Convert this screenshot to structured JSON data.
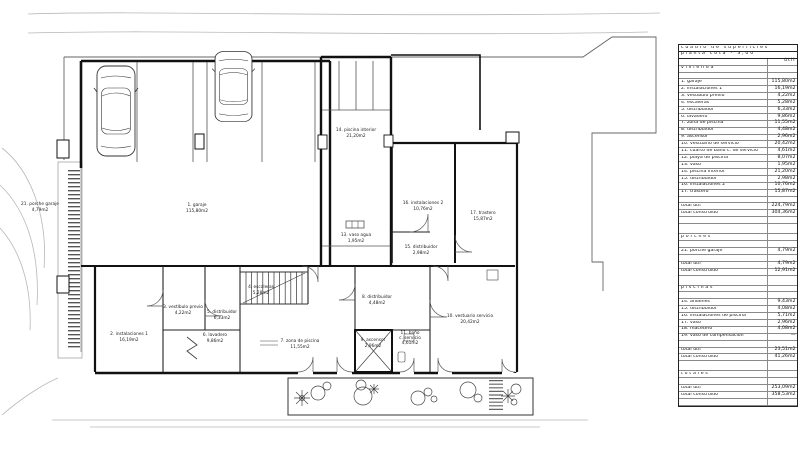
{
  "colors": {
    "line": "#111111",
    "background": "#ffffff"
  },
  "table": {
    "title1": "cuadro de superficies",
    "title2": "planta cota - 3,00",
    "col_util": "útil",
    "rows": [
      {
        "type": "title",
        "label": "cuadro de superficies"
      },
      {
        "type": "title",
        "label": "planta cota - 3,00"
      },
      {
        "type": "colhead",
        "label": "",
        "value": "útil"
      },
      {
        "type": "section",
        "label": "vivienda",
        "value": ""
      },
      {
        "type": "blank",
        "label": "",
        "value": ""
      },
      {
        "type": "item",
        "label": "1. garaje",
        "value": "115,80m2"
      },
      {
        "type": "item",
        "label": "2. instalaciones 1",
        "value": "16,19m2"
      },
      {
        "type": "item",
        "label": "3. vestíbulo previo",
        "value": "4,22m2"
      },
      {
        "type": "item",
        "label": "4. escaleras",
        "value": "5,28m2"
      },
      {
        "type": "item",
        "label": "5. distribuidor",
        "value": "6,33m2"
      },
      {
        "type": "item",
        "label": "6. lavadero",
        "value": "9,86m2"
      },
      {
        "type": "item",
        "label": "7. zona de piscina",
        "value": "11,55m2"
      },
      {
        "type": "item",
        "label": "8. distribuidor",
        "value": "4,48m2"
      },
      {
        "type": "item",
        "label": "9. ascensor",
        "value": "2,96m2"
      },
      {
        "type": "item",
        "label": "10. vestuario de servicio",
        "value": "20,42m2"
      },
      {
        "type": "item",
        "label": "11. cuarto de baño c. de servicio",
        "value": "4,61m2"
      },
      {
        "type": "item",
        "label": "12. playa de piscina",
        "value": "8,07m2"
      },
      {
        "type": "item",
        "label": "13. vaso",
        "value": "1,95m2"
      },
      {
        "type": "item",
        "label": "14. piscina interior",
        "value": "21,20m2"
      },
      {
        "type": "item",
        "label": "15. distribuidor",
        "value": "2,98m2"
      },
      {
        "type": "item",
        "label": "16. instalaciones 2",
        "value": "10,76m2"
      },
      {
        "type": "item",
        "label": "17. trastero",
        "value": "15,87m2"
      },
      {
        "type": "blank",
        "label": "",
        "value": ""
      },
      {
        "type": "total",
        "label": "total útil",
        "value": "224,79m2"
      },
      {
        "type": "total",
        "label": "total construido",
        "value": "304,36m2"
      },
      {
        "type": "blank",
        "label": "",
        "value": ""
      },
      {
        "type": "blank2",
        "label": "",
        "value": ""
      },
      {
        "type": "section",
        "label": "porches",
        "value": ""
      },
      {
        "type": "blank",
        "label": "",
        "value": ""
      },
      {
        "type": "item",
        "label": "21. porche garaje",
        "value": "4,79m2"
      },
      {
        "type": "blank",
        "label": "",
        "value": ""
      },
      {
        "type": "total",
        "label": "total útil",
        "value": "4,79m2"
      },
      {
        "type": "total",
        "label": "total construido",
        "value": "12,91m2"
      },
      {
        "type": "blank2",
        "label": "",
        "value": ""
      },
      {
        "type": "section",
        "label": "piscinas",
        "value": ""
      },
      {
        "type": "blank",
        "label": "",
        "value": ""
      },
      {
        "type": "item",
        "label": "14. andenes",
        "value": "9,43m2"
      },
      {
        "type": "item",
        "label": "15. distribuidor",
        "value": "4,08m2"
      },
      {
        "type": "item",
        "label": "16. instalaciones de piscina",
        "value": "5,71m2"
      },
      {
        "type": "item",
        "label": "17. vaso",
        "value": "2,96m2"
      },
      {
        "type": "item",
        "label": "18. macetero",
        "value": "4,08m2"
      },
      {
        "type": "item",
        "label": "19. vaso de compensación",
        "value": "—"
      },
      {
        "type": "blank",
        "label": "",
        "value": ""
      },
      {
        "type": "total",
        "label": "total útil",
        "value": "23,51m2"
      },
      {
        "type": "total",
        "label": "total construido",
        "value": "41,26m2"
      },
      {
        "type": "blank2",
        "label": "",
        "value": ""
      },
      {
        "type": "section",
        "label": "totales",
        "value": ""
      },
      {
        "type": "blank",
        "label": "",
        "value": ""
      },
      {
        "type": "total",
        "label": "total útil",
        "value": "253,09m2"
      },
      {
        "type": "total",
        "label": "total construido",
        "value": "358,53m2"
      },
      {
        "type": "blank",
        "label": "",
        "value": ""
      }
    ]
  },
  "plan": {
    "rooms": [
      {
        "name": "1. garaje",
        "area": "115,80m2"
      },
      {
        "name": "2. instalaciones 1",
        "area": "16,19m2"
      },
      {
        "name": "3. vestíbulo previo",
        "area": "4,22m2"
      },
      {
        "name": "4. escaleras",
        "area": "5,28m2"
      },
      {
        "name": "5. distribuidor",
        "area": "6,33m2"
      },
      {
        "name": "6. lavadero",
        "area": "9,86m2"
      },
      {
        "name": "7. zona de piscina",
        "area": "11,55m2"
      },
      {
        "name": "8. distribuidor",
        "area": "4,48m2"
      },
      {
        "name": "9. ascensor",
        "area": "2,96m2"
      },
      {
        "name": "10. vestuario servicio",
        "area": "20,42m2"
      },
      {
        "name": "11. baño",
        "name2": "c. servicio",
        "area": "4,61m2"
      },
      {
        "name": "13. vaso agua",
        "area": "1,95m2"
      },
      {
        "name": "14. piscina interior",
        "area": "21,20m2"
      },
      {
        "name": "15. distribuidor",
        "area": "2,98m2"
      },
      {
        "name": "16. instalaciones 2",
        "area": "10,76m2"
      },
      {
        "name": "17. trastero",
        "area": "15,87m2"
      },
      {
        "name": "21. porche garaje",
        "area": "4,79m2"
      }
    ]
  }
}
